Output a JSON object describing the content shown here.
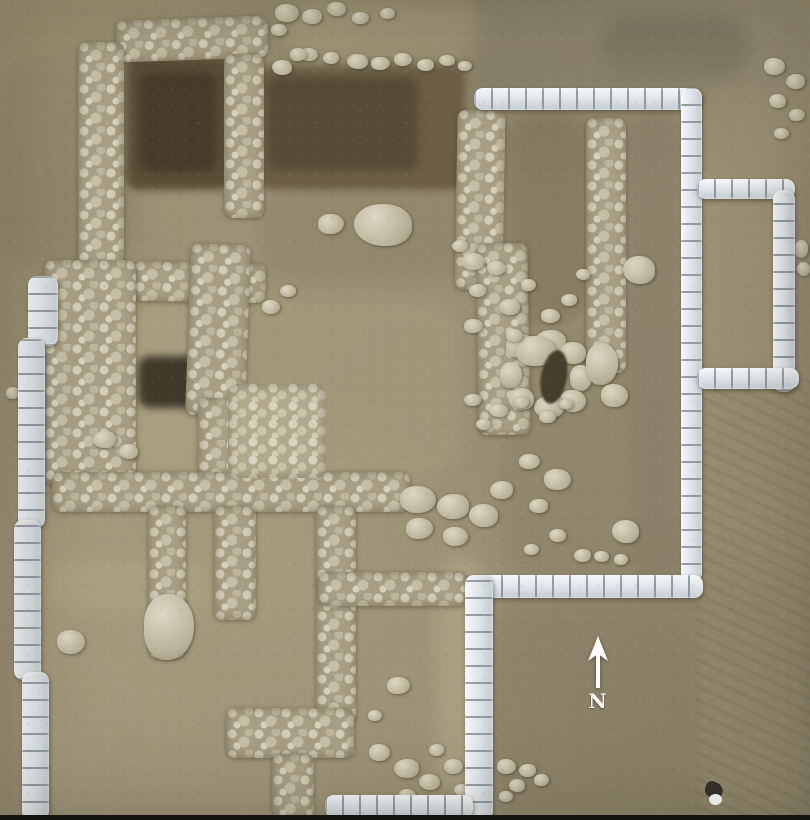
{
  "scene": {
    "compass_label": "N"
  },
  "colors": {
    "soil": "#9d9277",
    "soil_light": "#b3a88c",
    "soil_dark": "#847a62",
    "pit": "#5a4e37",
    "pit_deep": "#463c29",
    "stone": "#c9c1a9",
    "stone_dark": "#a89e85",
    "sandbag": "#e2e6e9",
    "sandbag_shadow": "#9aa2a8",
    "arrow_white": "#ffffff",
    "frame_bottom": "#14130d"
  }
}
